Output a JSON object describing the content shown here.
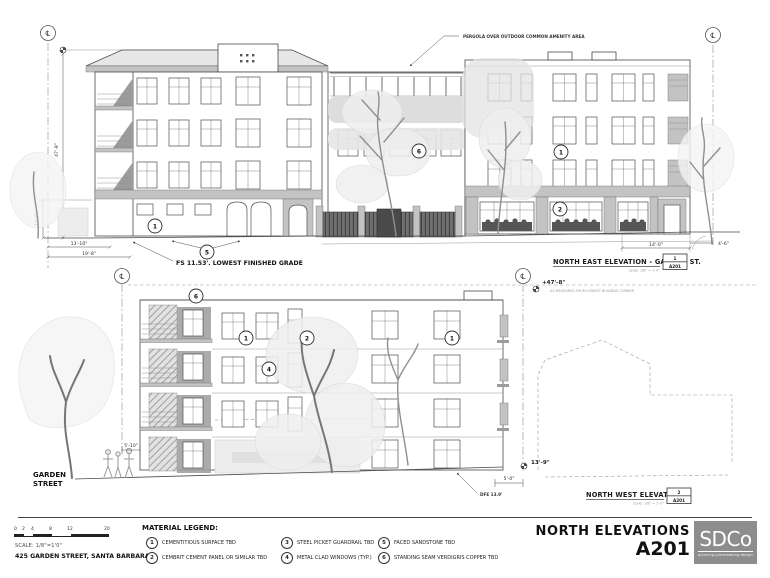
{
  "sheet": {
    "title": "NORTH ELEVATIONS",
    "number": "A201",
    "address": "425 GARDEN STREET, SANTA BARBARA",
    "scale_label": "SCALE: 1/8\"=1'0\"",
    "scale_ticks": [
      "0",
      "2",
      "4",
      "8",
      "12",
      "20"
    ],
    "logo_text": "SDCo",
    "logo_tagline": "planning.placemaking.design",
    "cl_symbol": "℄"
  },
  "legend": {
    "heading": "MATERIAL LEGEND:",
    "items": [
      {
        "num": "1",
        "label": "CEMENTITIOUS SURFACE TBD"
      },
      {
        "num": "2",
        "label": "CEMBRIT CEMENT PANEL OR SIMILAR TBD"
      },
      {
        "num": "3",
        "label": "STEEL PICKET GUARDRAIL TBD"
      },
      {
        "num": "4",
        "label": "METAL CLAD WINDOWS (TYP.)"
      },
      {
        "num": "5",
        "label": "FACED SANDSTONE TBD"
      },
      {
        "num": "6",
        "label": "STANDING SEAM VERDIGRIS COPPER TBD"
      }
    ]
  },
  "ne": {
    "title": "NORTH EAST ELEVATION -  GARDEN ST.",
    "detail_num": "1",
    "sheet_ref": "A201",
    "scale_note": "scale: 1/8\" = 1'-0\"",
    "pergola_note": "PERGOLA OVER OUTDOOR COMMON AMENITY AREA",
    "grade_note": "FS 11.53'. LOWEST FINISHED GRADE",
    "dim_height": "47'-8\"",
    "dim_ground_floor": "10'-6\"",
    "dim_a": "13'-10\"",
    "dim_b": "19'-8\"",
    "dim_c": "14'-0\"",
    "dim_d": "4'-6\"",
    "callouts": {
      "a": "1",
      "b": "5",
      "c": "6",
      "d": "1",
      "e": "2"
    }
  },
  "datum": {
    "value": "+47'-8\"",
    "note": "AS MEASURED FROM LOWEST BUILDING CORNER"
  },
  "nw": {
    "title": "NORTH WEST ELEVATION",
    "detail_num": "2",
    "sheet_ref": "A201",
    "scale_note": "scale: 1/8\" = 1'-0\"",
    "street_line1": "GARDEN",
    "street_line2": "STREET",
    "dim_setback": "5'-10\"",
    "dim_height_right": "13'-9\"",
    "dim_e": "5'-0\"",
    "dfe_note": "DFE 13.9'",
    "callouts": {
      "a": "6",
      "b": "1",
      "c": "2",
      "d": "4",
      "e": "1"
    }
  }
}
